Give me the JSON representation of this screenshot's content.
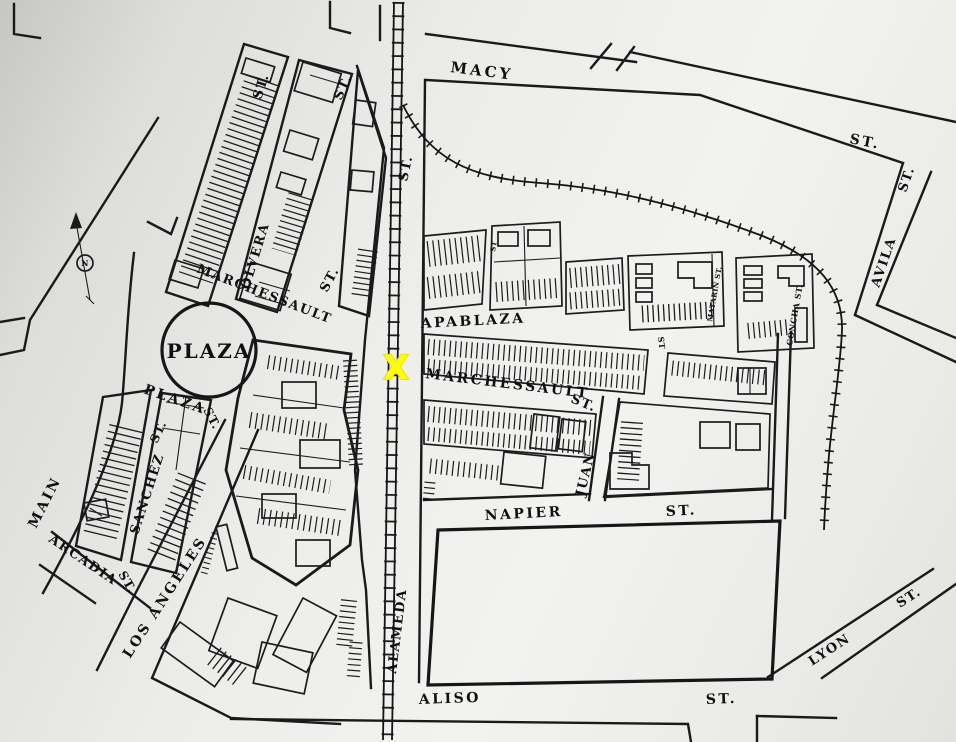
{
  "labels": {
    "macy": "MACY",
    "macy_st": "ST.",
    "avila": "AVILA",
    "avila_st": "ST.",
    "alameda_top_st": "ST.",
    "olvera": "OLVERA",
    "olvera_w_st": "ST.",
    "olvera_e_st": "ST.",
    "marchessault_w": "MARCHESSAULT",
    "marchessault_w_st": "ST.",
    "plaza": "PLAZA",
    "plaza_st_name": "PLAZA",
    "plaza_st": "ST.",
    "main": "MAIN",
    "sanchez": "SANCHEZ",
    "sanchez_st": "ST.",
    "arcadia": "ARCADIA",
    "arcadia_st": "ST.",
    "los_angeles": "LOS ANGELES",
    "apablaza": "APABLAZA",
    "marchessault_e": "MARCHESSAULT",
    "marchessault_e_st": "ST.",
    "lane_st": "ST",
    "block_st": "ST",
    "juan": "JUAN",
    "napier": "NAPIER",
    "napier_st": "ST.",
    "alameda": "ALAMEDA",
    "aliso": "ALISO",
    "aliso_st": "ST.",
    "lyon": "LYON",
    "lyon_st": "ST.",
    "concha_st": "CONCHA ST.",
    "matarin_st": "MATARIN ST.",
    "compass_n": "N"
  },
  "marker": {
    "symbol": "X",
    "color": "#FFFF00"
  }
}
